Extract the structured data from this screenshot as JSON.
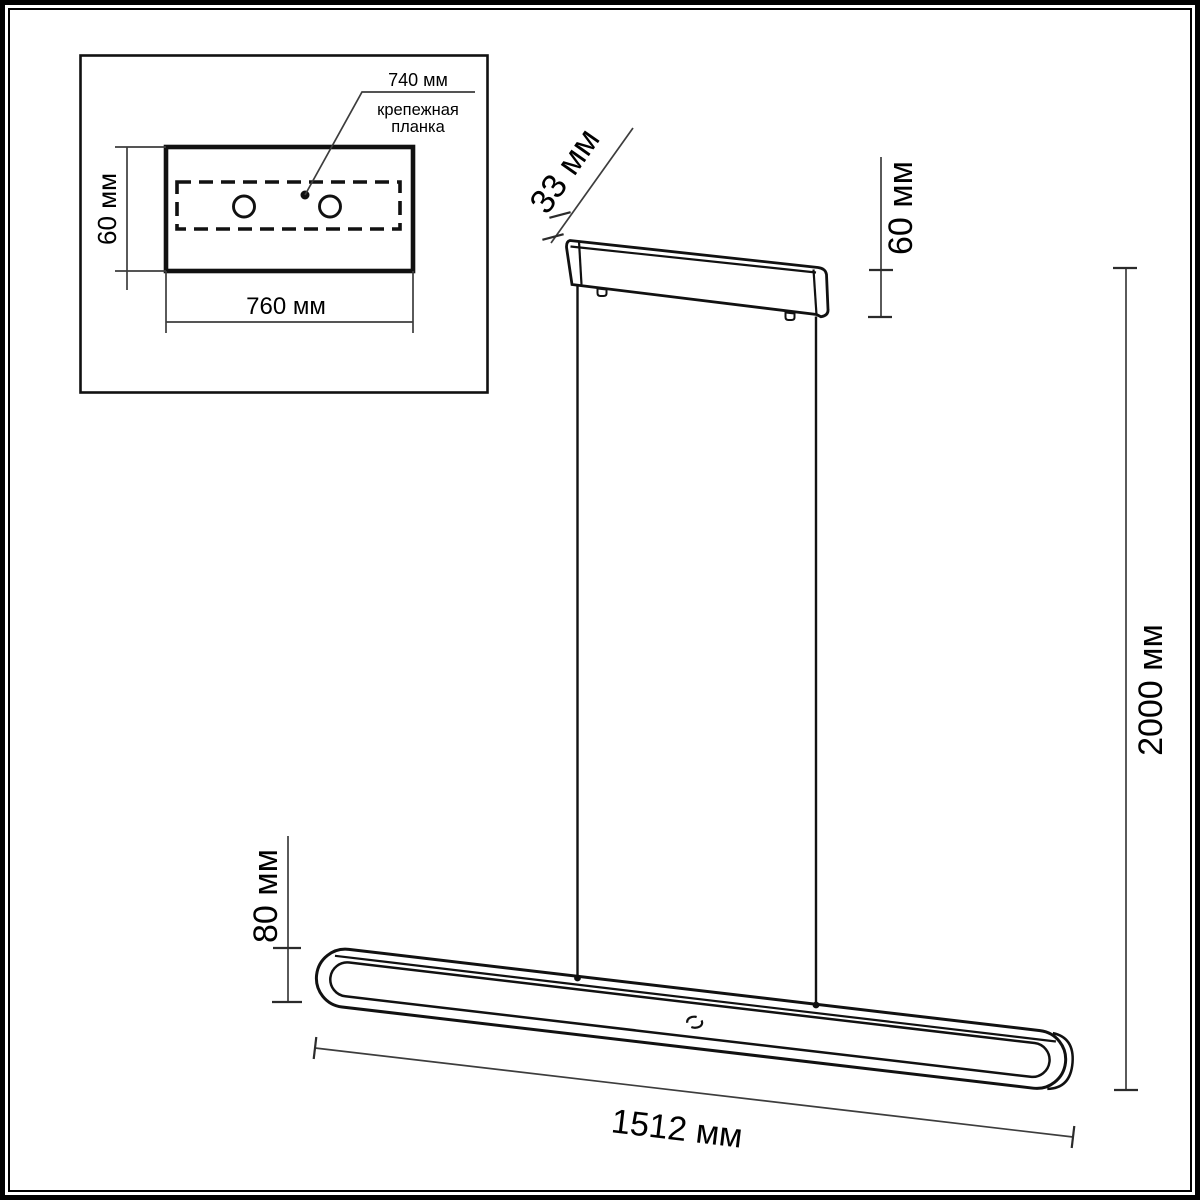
{
  "figure": {
    "title_hint": "pendant luminaire dimension drawing",
    "inset": {
      "plate_width_label": "740 мм",
      "plate_name_line1": "крепежная",
      "plate_name_line2": "планка",
      "canopy_height_label": "60 мм",
      "canopy_width_label": "760 мм"
    },
    "main": {
      "canopy_depth_label": "33 мм",
      "canopy_height_label": "60 мм",
      "suspension_length_label": "2000 мм",
      "bar_height_label": "80 мм",
      "bar_length_label": "1512 мм"
    },
    "colors": {
      "outline": "#111111",
      "dimension_line": "#3d3d3d",
      "background": "#ffffff"
    }
  }
}
